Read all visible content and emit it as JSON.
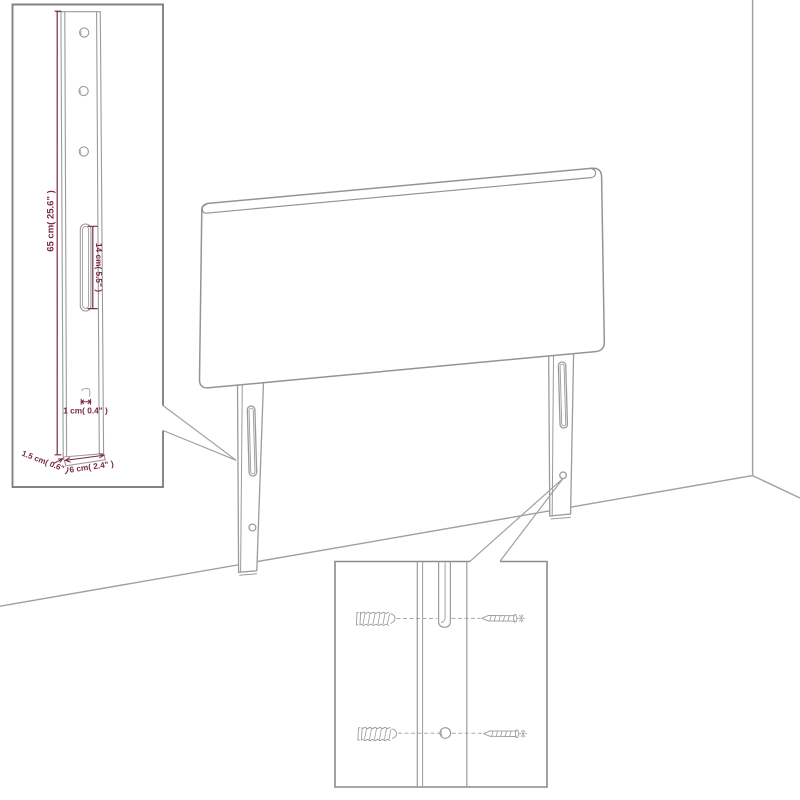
{
  "colors": {
    "line": "#9b9b9b",
    "inset_border": "#828282",
    "dimension": "#7a2748",
    "background": "#ffffff"
  },
  "dimensions": {
    "leg_height": "65 cm( 25.6\" )",
    "slot_length": "14 cm( 5.5\" )",
    "edge": "1 cm( 0.4\" )",
    "leg_thickness": "1.5 cm( 0.6\" )",
    "leg_width": "6 cm( 2.4\" )"
  }
}
